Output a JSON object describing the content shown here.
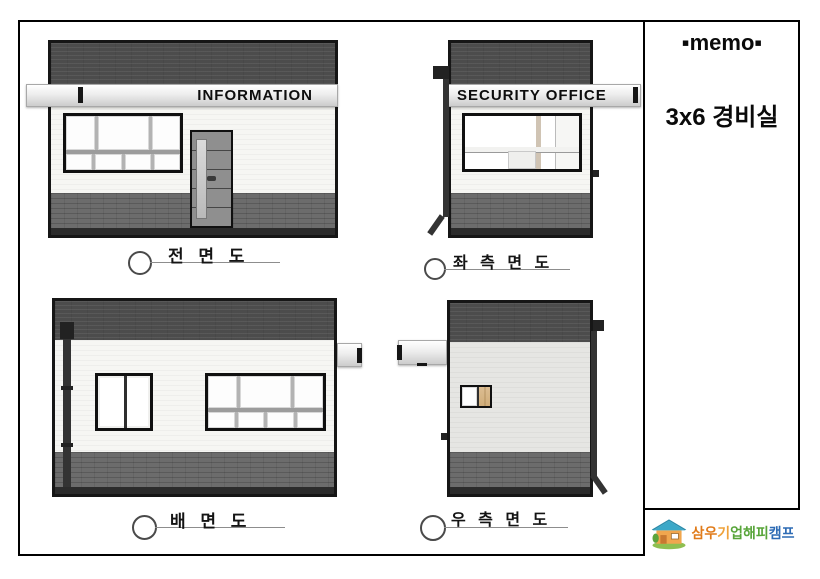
{
  "sheet": {
    "memo_header": "▪memo▪",
    "project_title": "3x6 경비실"
  },
  "signs": {
    "front": "INFORMATION",
    "side": "SECURITY OFFICE"
  },
  "view_labels": {
    "front": "전 면 도",
    "left": "좌 측 면 도",
    "back": "배 면 도",
    "right": "우 측 면 도"
  },
  "logo": {
    "company": "삼우기업해피캠프",
    "chars": [
      "삼",
      "우",
      "기",
      "업",
      "해",
      "피",
      "캠",
      "프"
    ],
    "colors": [
      "#e07b1a",
      "#e07b1a",
      "#efa23b",
      "#58a53a",
      "#58a53a",
      "#58a53a",
      "#2e6cb5",
      "#2e6cb5"
    ]
  },
  "palette": {
    "parapet_dark": "#4c4c4c",
    "wainscot_gray": "#6c6c6c",
    "base_black": "#2b2b2b",
    "wall_white": "#f6f6f3",
    "wall_light_gray": "#e6e6e3",
    "sign_silver": "#ededed",
    "wood_panel": "#d7b685",
    "door_gray": "#8f8f8f",
    "line_gray": "#8d8d8d"
  }
}
